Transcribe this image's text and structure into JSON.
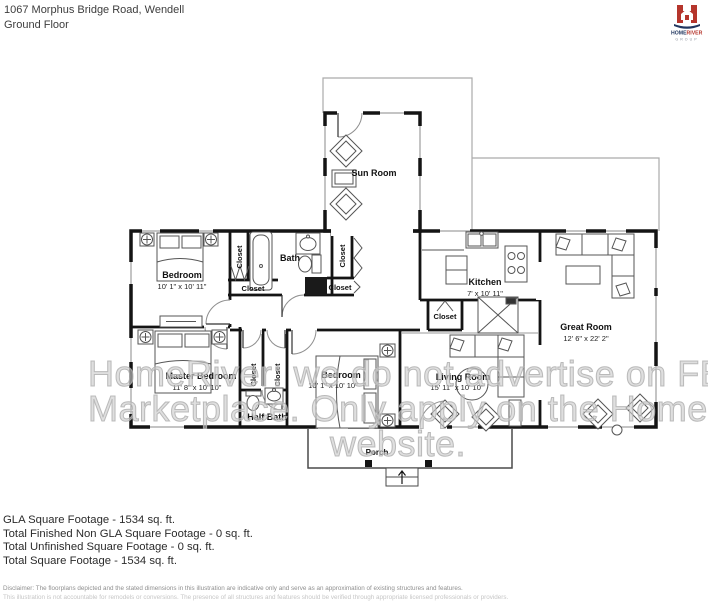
{
  "header": {
    "address": "1067 Morphus Bridge Road, Wendell",
    "floor_label": "Ground Floor"
  },
  "logo": {
    "brand_top": "HOME",
    "brand_bottom": "RIVER",
    "group": "GROUP"
  },
  "plan": {
    "closet_label": "Closet",
    "rooms": {
      "sun_room": {
        "name": "Sun Room"
      },
      "bedroom_top": {
        "name": "Bedroom",
        "dims": "10' 1\" x 10' 11\""
      },
      "bath": {
        "name": "Bath"
      },
      "kitchen": {
        "name": "Kitchen",
        "dims": "7' x 10' 11\""
      },
      "great_room": {
        "name": "Great Room",
        "dims": "12' 6\" x 22' 2\""
      },
      "master_bedroom": {
        "name": "Master Bedroom",
        "dims": "11' 8\" x 10' 10\""
      },
      "bedroom_middle": {
        "name": "Bedroom",
        "dims": "10' 1\" x 10' 10\""
      },
      "half_bath": {
        "name": "Half Bath"
      },
      "living_room": {
        "name": "Living Room",
        "dims": "15' 11\" x 10' 10\""
      },
      "porch": {
        "name": "Porch"
      }
    }
  },
  "watermark": {
    "line1": "HomeRiver: we do not advertise on FB",
    "line2": "Marketplace. Only apply on the HomeRiver",
    "line3": "website."
  },
  "footer": {
    "gla": "GLA Square Footage - 1534 sq. ft.",
    "non_gla": "Total Finished Non GLA Square Footage - 0 sq. ft.",
    "unfinished": "Total Unfinished Square Footage - 0 sq. ft.",
    "total": "Total Square Footage - 1534 sq. ft.",
    "disclaimer_line1": "Disclaimer: The floorplans depicted and the stated dimensions in this illustration are indicative only and serve as an approximation of existing structures and features.",
    "disclaimer_line2": "This illustration is not accountable for remodels or conversions. The presence of all structures and features should be verified through appropriate licensed professionals or providers."
  },
  "colors": {
    "wall": "#141414",
    "boundary": "#aaaaaa",
    "furniture": "#555555",
    "watermark": "#c6c6c6",
    "logo_red": "#b5352c",
    "logo_navy": "#20365f"
  }
}
